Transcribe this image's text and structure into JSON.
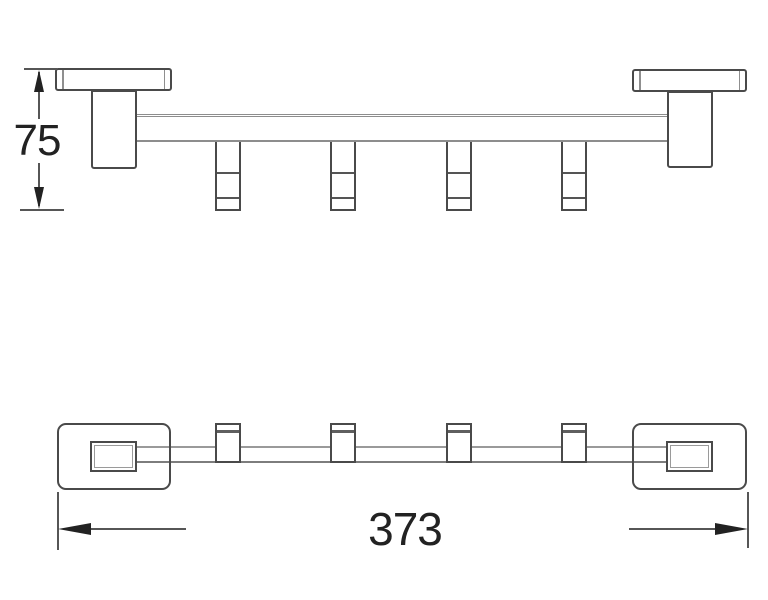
{
  "drawing": {
    "type": "technical-drawing",
    "subject": "towel bar with four sliding hooks, two wall mounts",
    "background_color": "#ffffff",
    "outline_color": "#4a4a4a",
    "light_line_color": "#9a9a9a",
    "dimension_line_color": "#565656",
    "arrow_color": "#222222",
    "text_color": "#222222",
    "views": {
      "front": {
        "label": "front elevation",
        "hook_count": 4
      },
      "plan": {
        "label": "plan view",
        "hook_count": 4
      }
    },
    "dims": {
      "height": {
        "value": "75",
        "orientation": "vertical",
        "view": "front"
      },
      "length": {
        "value": "373",
        "orientation": "horizontal",
        "view": "plan"
      }
    }
  }
}
